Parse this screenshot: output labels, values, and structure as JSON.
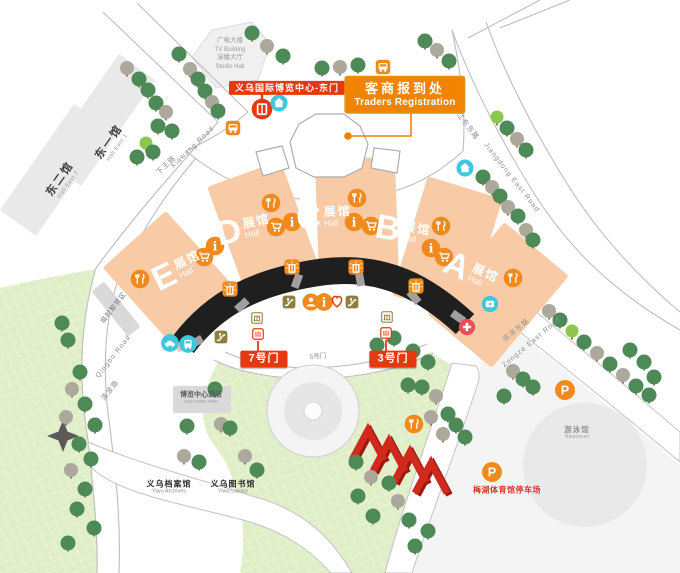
{
  "map": {
    "buildings": {
      "hall_east_2": {
        "zh": "东二馆",
        "en": "Hall East 2"
      },
      "hall_east_1": {
        "zh": "东一馆",
        "en": "Hall East 1"
      },
      "tv_building": {
        "line1": "广电大楼",
        "line2": "TV Building",
        "line3": "演播大厅",
        "line4": "Studio Hall"
      },
      "hotel": {
        "zh": "博览中心酒店",
        "en": "Expo Center Hotel"
      },
      "archives": {
        "zh": "义乌档案馆",
        "en": "Yiwu Archives"
      },
      "library": {
        "zh": "义乌图书馆",
        "en": "Yiwu Library"
      },
      "natatorium": {
        "zh": "游泳馆",
        "en": "Natatorium"
      }
    },
    "halls": [
      {
        "letter": "E",
        "zh": "展馆",
        "en": "Hall"
      },
      {
        "letter": "D",
        "zh": "展馆",
        "en": "Hall"
      },
      {
        "letter": "C",
        "zh": "展馆",
        "en": "Hall"
      },
      {
        "letter": "B",
        "zh": "展馆",
        "en": "Hall"
      },
      {
        "letter": "A",
        "zh": "展馆",
        "en": "Hall"
      }
    ],
    "gates": {
      "gate7": "7号门",
      "gate5": "5号门",
      "gate3": "3号门"
    },
    "callouts": {
      "east_gate": "义乌国际博览中心-东门",
      "traders_zh": "客商报到处",
      "traders_en": "Traders Registration"
    },
    "roads": {
      "xiawang_zh": "下王路",
      "xiawang_en": "Xiawang Road",
      "jiangdong_zh": "江东东路",
      "jiangdong_en": "Jiangdong East Road",
      "zongze_zh": "宗泽东路",
      "zongze_en": "Zongze East Road",
      "qingbo_zh": "清波路",
      "qingbo_en": "Qingbo Road"
    },
    "areas": {
      "unloading": "临时卸货区",
      "meihu_parking": "梅湖体育馆停车场"
    },
    "letters": {
      "parking": "P",
      "info": "i"
    }
  },
  "icons": {
    "bus-stop-icon": "orange square with white bus",
    "east-gate-icon": "red circle with white gate",
    "service-center-icon": "teal circle with white house",
    "restaurant-icon": "orange circle with fork and knife",
    "shopping-icon": "orange circle with shopping cart",
    "information-icon": "orange circle with letter i",
    "person-icon": "orange circle with visitor bust",
    "heart-icon": "white heart with red outline",
    "escalator-icon": "olive square with escalator",
    "hall-entrance-icon": "orange square with glowing door",
    "checkpoint-icon": "white square with olive gate frame",
    "gate-pin-icon": "white square with red fence",
    "taxi-icon": "teal circle with car",
    "shuttle-bus-icon": "teal circle with bus front",
    "media-icon": "teal circle with play screen",
    "first-aid-icon": "red circle with white cross",
    "parking-icon": "orange circle with letter P",
    "compass-icon": "gray four point star",
    "tree-icon": "green or gray round tree",
    "red-arches-sculpture": "four red zigzag arches"
  },
  "colors": {
    "red": "#e6380f",
    "orange": "#f08a1d",
    "deep_orange": "#f08300",
    "teal": "#3ec7de",
    "olive": "#8f7f3c",
    "peach": "#f8cba6",
    "arc_black": "#1f1f1f",
    "lawn": "#dfeec6",
    "tree_green": "#4d8a58",
    "tree_gray": "#aca89b",
    "tree_light": "#8cc74f"
  }
}
